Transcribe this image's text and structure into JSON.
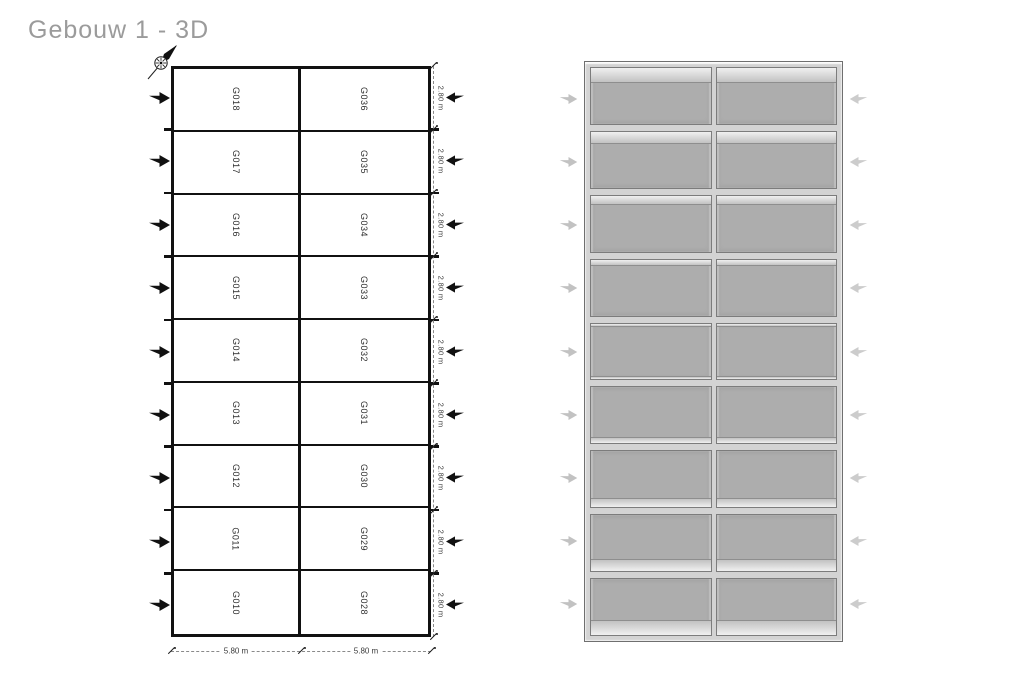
{
  "title": "Gebouw 1 - 3D",
  "compass": {
    "icon": "compass-rose-north-east"
  },
  "floor_plan": {
    "left_units": [
      "G018",
      "G017",
      "G016",
      "G015",
      "G014",
      "G013",
      "G012",
      "G011",
      "G010"
    ],
    "right_units": [
      "G036",
      "G035",
      "G034",
      "G033",
      "G032",
      "G031",
      "G030",
      "G029",
      "G028"
    ],
    "row_dim_labels": [
      "2.80 m",
      "2.80 m",
      "2.80 m",
      "2.80 m",
      "2.80 m",
      "2.80 m",
      "2.80 m",
      "2.80 m",
      "2.80 m"
    ],
    "col_dim_labels": [
      "5.80 m",
      "5.80 m"
    ],
    "left_door_arrows": 9,
    "right_door_arrows": 9,
    "door_arrow_icon": "solid-block-arrow"
  },
  "view_3d": {
    "rows": 9,
    "cols": 2,
    "left_entry_arrows": 9,
    "right_entry_arrows": 9,
    "entry_arrow_icon": "solid-block-arrow-faded"
  },
  "colors": {
    "title_text": "#9b9b9b",
    "plan_line": "#111111",
    "dim_line": "#8a8a8a",
    "dim_text": "#3a3a3a",
    "door_arrow": "#111111",
    "entry_arrow_3d_left": "#c2c2c2",
    "entry_arrow_3d_right": "#cccccc",
    "floor_3d": "#adadad",
    "wall_3d": "#d3d3d3"
  }
}
